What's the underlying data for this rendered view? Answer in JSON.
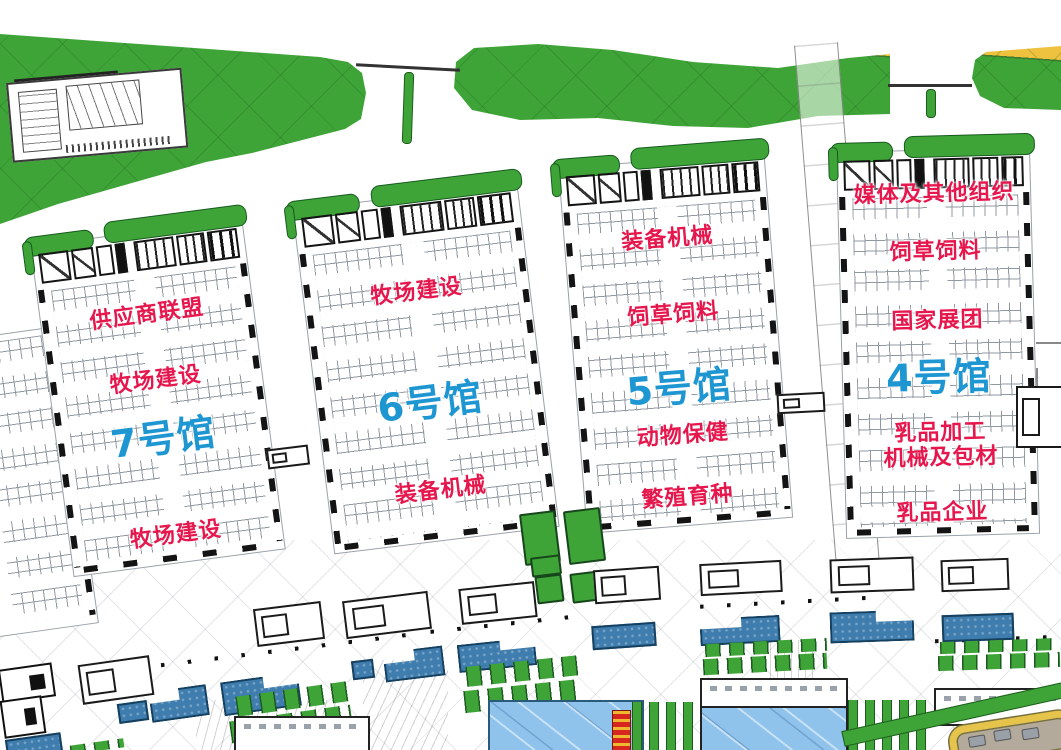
{
  "colors": {
    "hall_title_blue": "#1E96D2",
    "zone_label_red": "#E5174D",
    "landscape_green": "#3EA437",
    "landscape_yellow": "#EEC23F",
    "canopy_blue": "#3F7DAE",
    "water_blue": "#8FC3EC",
    "marker_red": "#D6281E"
  },
  "halls": [
    {
      "id": "hall-7",
      "title": "7号馆",
      "zones": [
        "供应商联盟",
        "牧场建设",
        "牧场建设"
      ]
    },
    {
      "id": "hall-6",
      "title": "6号馆",
      "zones": [
        "牧场建设",
        "装备机械"
      ]
    },
    {
      "id": "hall-5",
      "title": "5号馆",
      "zones": [
        "装备机械",
        "饲草饲料",
        "动物保健",
        "繁殖育种"
      ]
    },
    {
      "id": "hall-4",
      "title": "4号馆",
      "zones": [
        "媒体及其他组织",
        "饲草饲料",
        "国家展团",
        "乳品加工\n机械及包材",
        "乳品企业"
      ]
    }
  ]
}
